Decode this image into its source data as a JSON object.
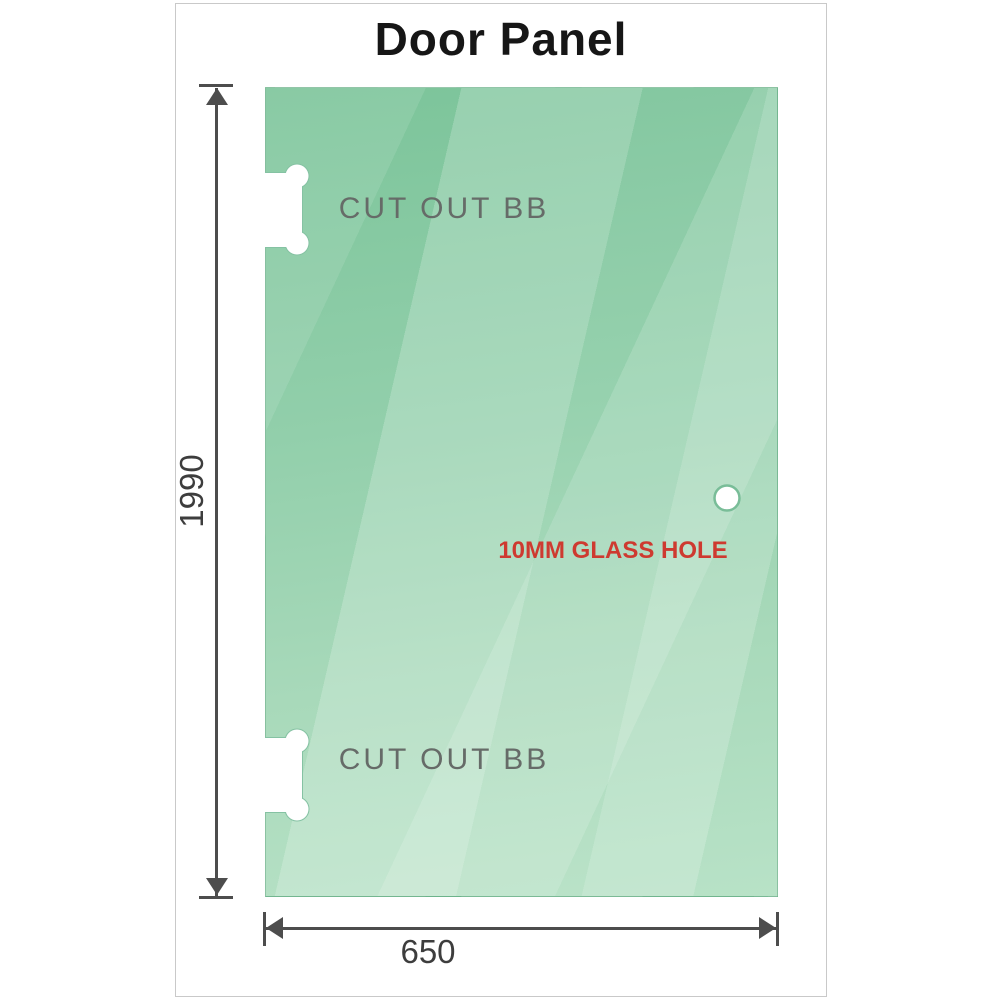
{
  "diagram": {
    "title": "Door Panel",
    "dimensions": {
      "height_value": "1990",
      "width_value": "650"
    },
    "annotations": {
      "cutout_top": "CUT OUT BB",
      "cutout_bottom": "CUT OUT BB",
      "glass_hole": "10MM GLASS HOLE"
    },
    "features": {
      "hinge_cutouts": 2,
      "glass_holes": 1
    },
    "colors": {
      "glass_green_dark": "#7CC49A",
      "glass_green_light": "#B8E2C7",
      "stripe_highlight": "#FFFFFF",
      "cutout_fill": "#FFFFFF",
      "cutout_edge": "#85C2A3",
      "dimension_line": "#4D4D4D",
      "dimension_text": "#3D3D3D",
      "cutout_text": "#666B68",
      "glass_hole_text": "#CE3A30",
      "frame_border": "#C9C9C9",
      "background": "#FFFFFF"
    }
  }
}
